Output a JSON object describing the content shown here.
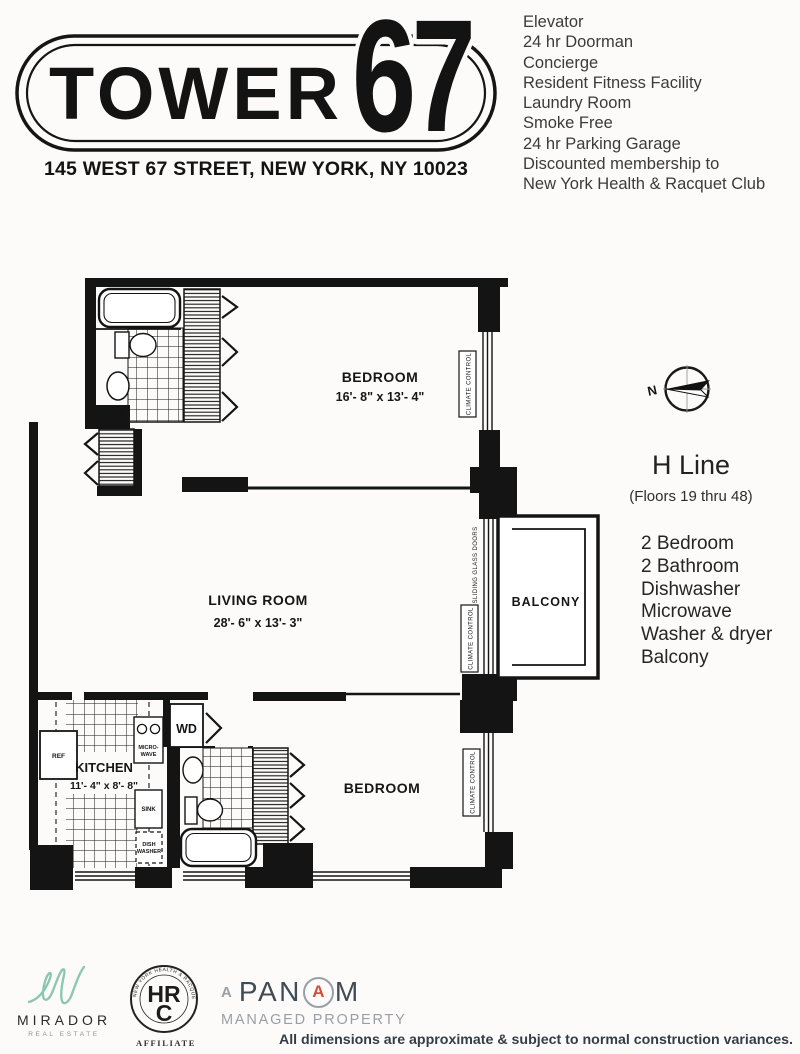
{
  "colors": {
    "ink": "#141414",
    "mirador_teal": "#8ac7ae",
    "panam_navy": "#3f4b55",
    "panam_gray": "#98a0a7",
    "panam_red": "#d84b38"
  },
  "header": {
    "name": "TOWER",
    "number": "67",
    "address": "145 WEST 67 STREET, NEW YORK, NY 10023"
  },
  "amenities": [
    "Elevator",
    "24 hr Doorman",
    "Concierge",
    "Resident Fitness Facility",
    "Laundry Room",
    "Smoke Free",
    "24 hr Parking Garage",
    "Discounted membership to",
    "New York Health & Racquet Club"
  ],
  "unit": {
    "line": "H Line",
    "floors": "(Floors 19 thru 48)",
    "features": [
      "2 Bedroom",
      "2 Bathroom",
      "Dishwasher",
      "Microwave",
      "Washer & dryer",
      "Balcony"
    ]
  },
  "plan": {
    "bedroom1": {
      "label": "BEDROOM",
      "dims": "16'- 8\" x 13'- 4\""
    },
    "living": {
      "label": "LIVING ROOM",
      "dims": "28'- 6\" x 13'- 3\""
    },
    "kitchen": {
      "label": "KITCHEN",
      "dims": "11'- 4\" x 8'- 8\""
    },
    "bedroom2": {
      "label": "BEDROOM"
    },
    "balcony": {
      "label": "BALCONY"
    },
    "climate": "CLIMATE CONTROL",
    "sliding": "SLIDING GLASS DOORS",
    "wd": "WD",
    "ref": "REF",
    "sink": "SINK",
    "micro1": "MICRO-",
    "micro2": "WAVE",
    "dish1": "DISH",
    "dish2": "WASHER",
    "north": "N"
  },
  "footer": {
    "mirador": {
      "name": "MIRADOR",
      "tagline": "REAL ESTATE"
    },
    "hrc": {
      "ring": "NEW YORK HEALTH & RACQUET CLUB",
      "mono1": "HR",
      "mono2": "C",
      "affiliate": "AFFILIATE"
    },
    "panam": {
      "a": "A",
      "p1": "PAN",
      "pa": "A",
      "p2": "M",
      "subtitle": "MANAGED PROPERTY"
    },
    "disclaimer": "All dimensions are approximate & subject to normal construction variances."
  }
}
